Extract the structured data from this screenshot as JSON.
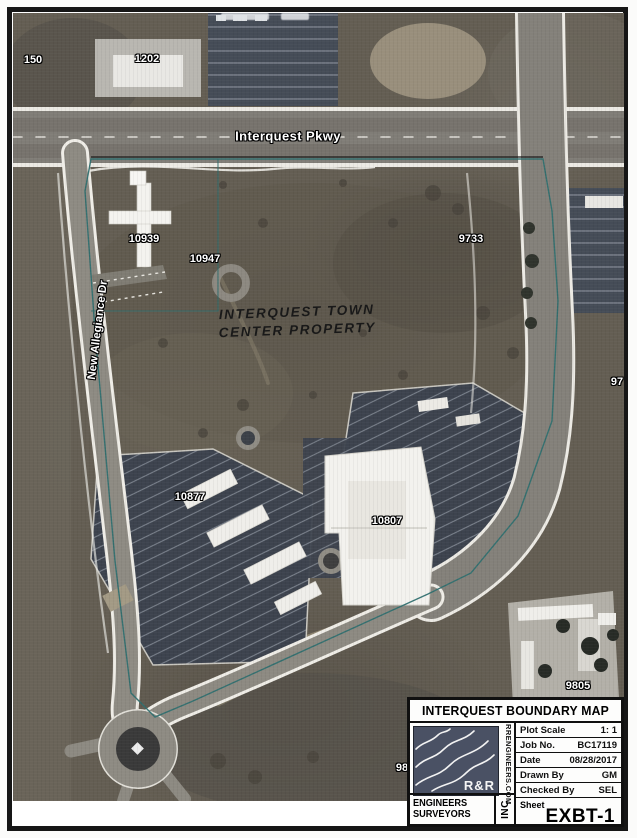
{
  "map": {
    "street_labels": {
      "interquest_pkwy": "Interquest Pkwy",
      "new_allegiance_dr": "New Allegiance Dr"
    },
    "property_label": {
      "line1": "INTERQUEST TOWN",
      "line2": "CENTER PROPERTY"
    },
    "parcel_labels": {
      "p150": "150",
      "p1202": "1202",
      "p10939": "10939",
      "p10947": "10947",
      "p9733": "9733",
      "p10877": "10877",
      "p10807": "10807",
      "p9805": "9805",
      "p97_partial": "97",
      "p98_partial": "98"
    },
    "colors": {
      "boundary_line": "#2f6f6f",
      "parking_lot": "#3d434e",
      "road": "#807d77",
      "terrain": "#645e53"
    }
  },
  "title_block": {
    "title": "INTERQUEST BOUNDARY MAP",
    "rows": [
      {
        "label": "Plot Scale",
        "value": "1: 1"
      },
      {
        "label": "Job No.",
        "value": "BC17119"
      },
      {
        "label": "Date",
        "value": "08/28/2017"
      },
      {
        "label": "Drawn By",
        "value": "GM"
      },
      {
        "label": "Checked By",
        "value": "SEL"
      }
    ],
    "sheet_label": "Sheet",
    "sheet_value": "EXBT-1",
    "logo": {
      "monogram": "R&R",
      "company_line1": "ENGINEERS",
      "company_line2": "SURVEYORS",
      "suffix": "INC",
      "website": "RRENGINEERS.COM",
      "background": "#4a5164"
    }
  }
}
